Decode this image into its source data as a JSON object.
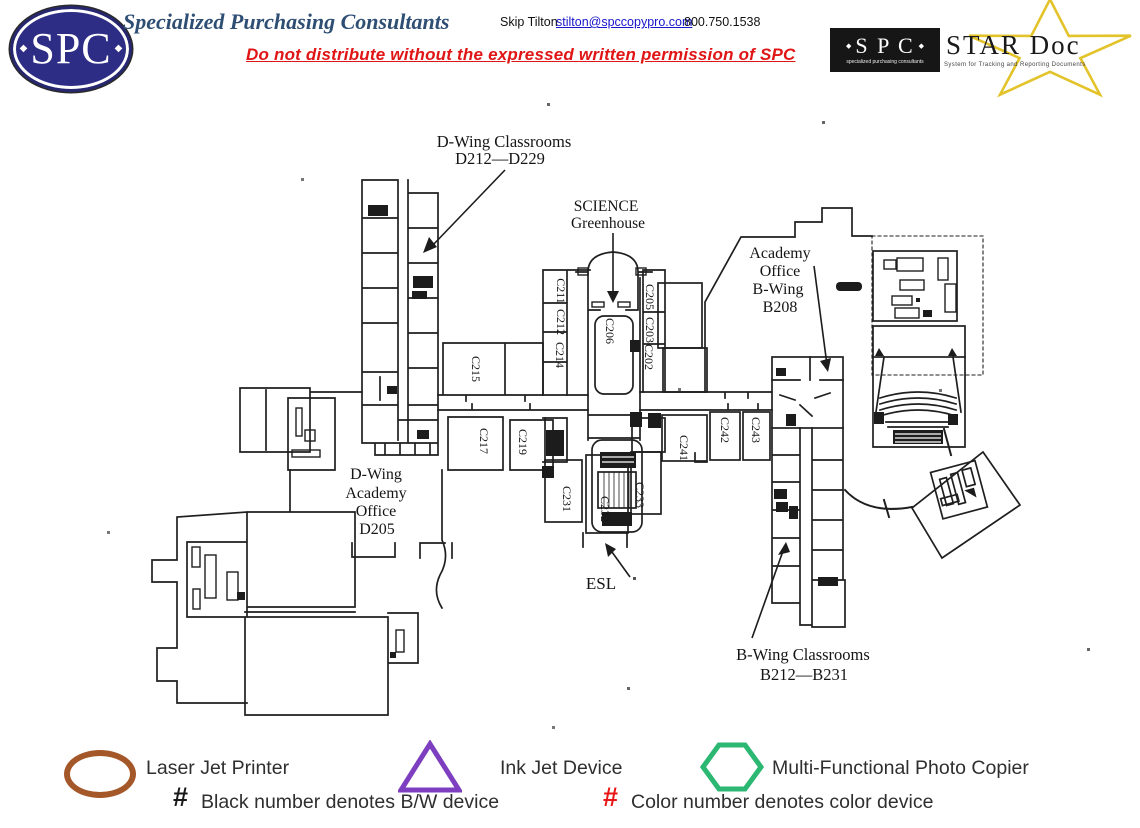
{
  "header": {
    "logo": {
      "text": "SPC",
      "bullet": "◆"
    },
    "company_name": "Specialized Purchasing Consultants",
    "contact": {
      "name": "Skip Tilton",
      "email": "stilton@spccopypro.com",
      "phone": "800.750.1538"
    },
    "disclaimer": "Do not distribute without the expressed written permission of SPC",
    "stardoc": {
      "bullet": "◆",
      "spc_text": "S P C",
      "spc_subtext": "specialized purchasing consultants",
      "title": "STAR Doc",
      "subtitle": "System for Tracking and Reporting Documents"
    }
  },
  "map": {
    "labels": {
      "dwing_classrooms": [
        "D-Wing Classrooms",
        "D212—D229"
      ],
      "science_greenhouse": [
        "SCIENCE",
        "Greenhouse"
      ],
      "academy_office_b": [
        "Academy",
        "Office",
        "B-Wing",
        "B208"
      ],
      "dwing_academy": [
        "D-Wing",
        "Academy",
        "Office",
        "D205"
      ],
      "esl": "ESL",
      "bwing_classrooms": [
        "B-Wing Classrooms",
        "B212—B231"
      ]
    },
    "rooms": {
      "c211": "C211",
      "c212": "C212",
      "c214": "C214",
      "c215": "C215",
      "c217": "C217",
      "c219": "C219",
      "c206": "C206",
      "c205": "C205",
      "c203": "C203",
      "c202": "C202",
      "c231": "C231",
      "c232": "C232",
      "c233": "C233",
      "c241": "C241",
      "c242": "C242",
      "c243": "C243"
    }
  },
  "legend": {
    "items": [
      {
        "shape": "ellipse",
        "color": "#a4582a",
        "label": "Laser Jet Printer"
      },
      {
        "shape": "triangle",
        "color": "#7d3fc0",
        "label": "Ink Jet Device"
      },
      {
        "shape": "hexagon",
        "color": "#2cb873",
        "label": "Multi-Functional Photo Copier"
      }
    ],
    "notes": [
      {
        "symbol": "#",
        "color": "#1a1a1a",
        "text": "Black number denotes B/W device"
      },
      {
        "symbol": "#",
        "color": "#e81717",
        "text": "Color number denotes color device"
      }
    ]
  }
}
